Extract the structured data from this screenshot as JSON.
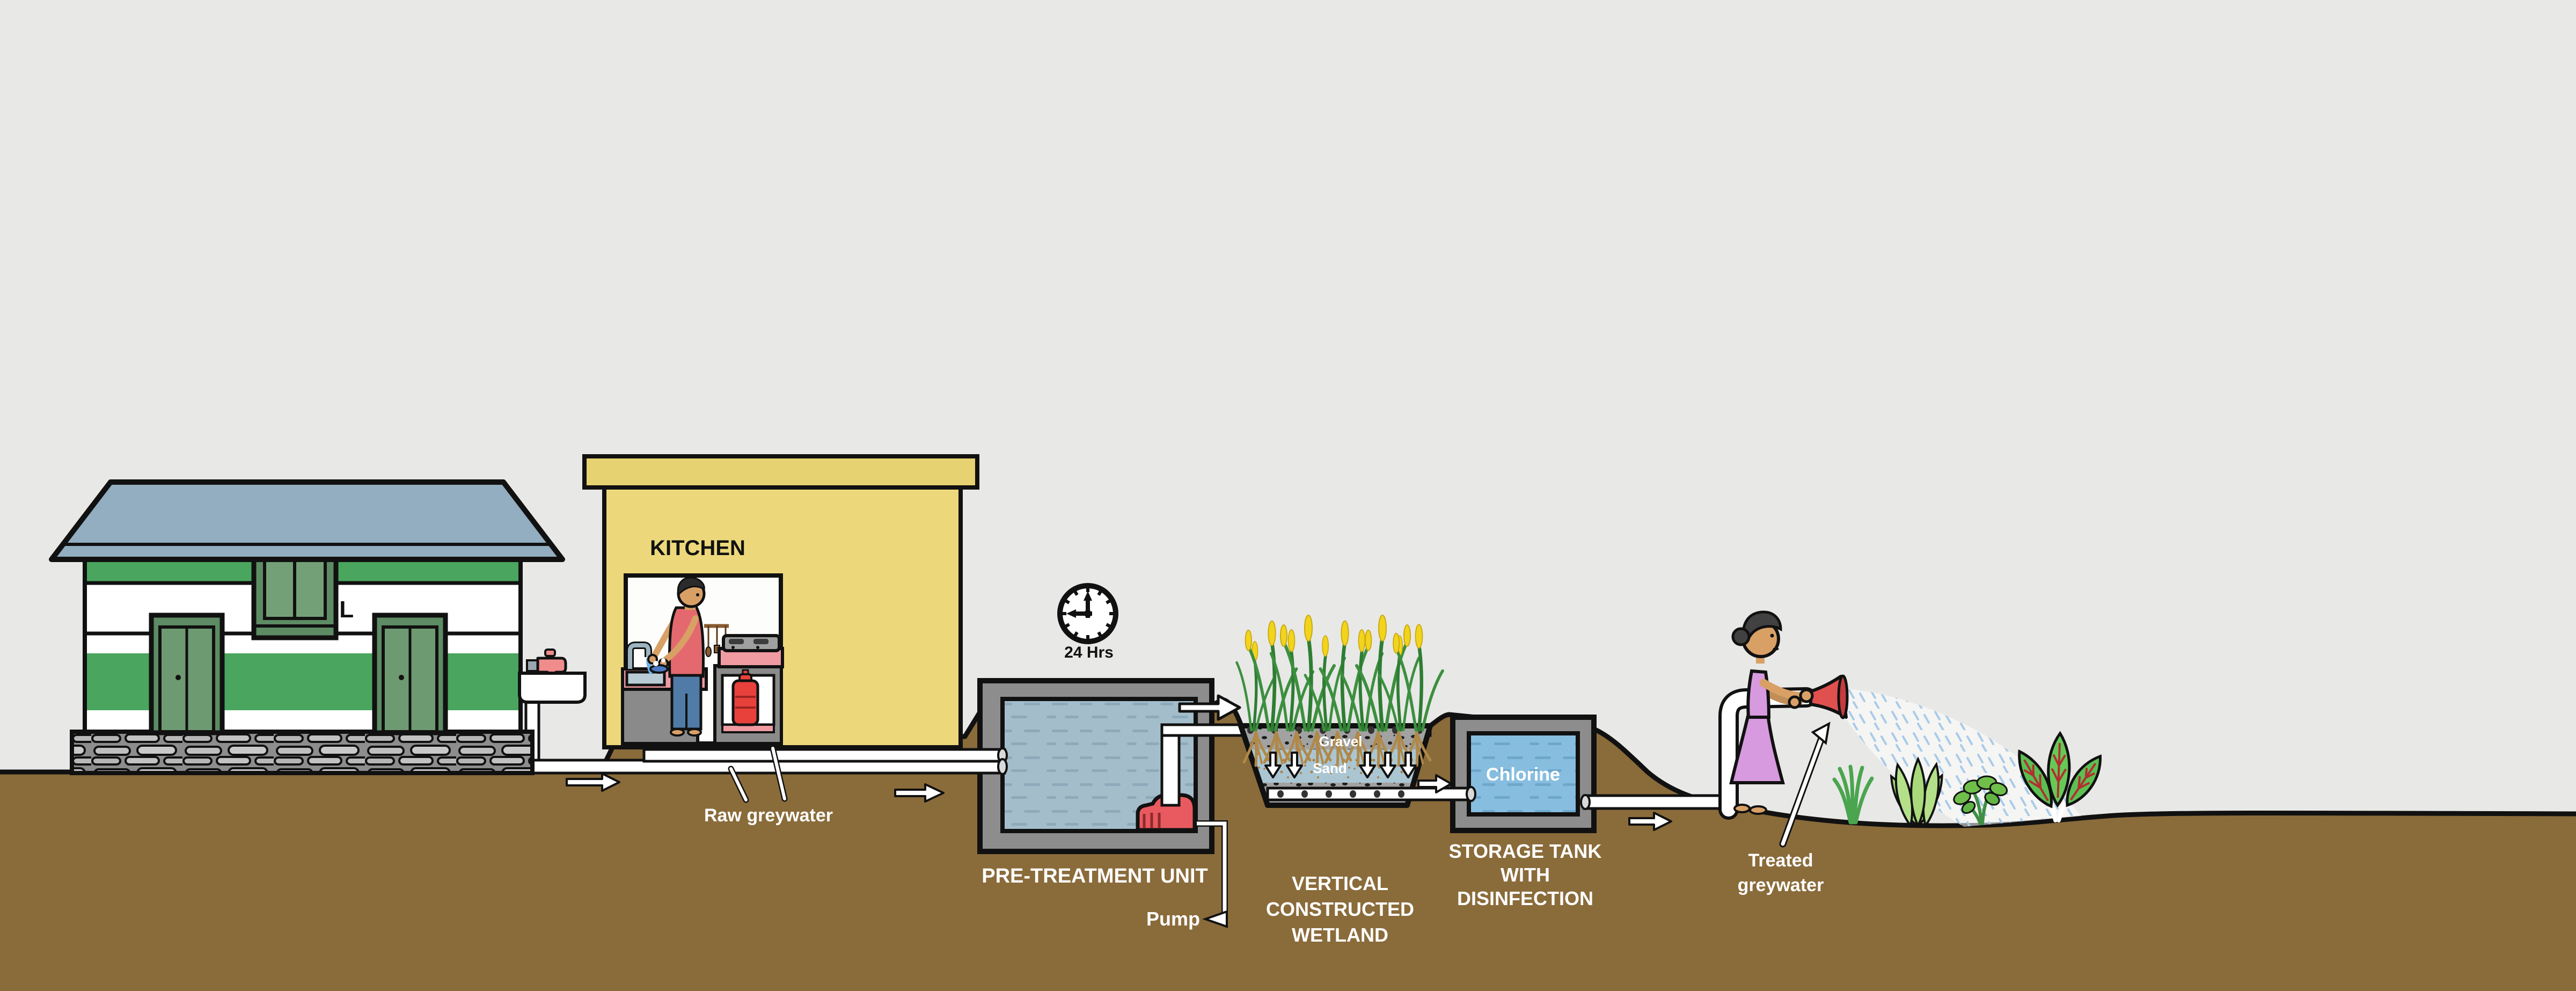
{
  "scene": {
    "sky_color": "#e8e8e7",
    "ground_color": "#8a6b3a",
    "pipe_color": "#ffffff",
    "accent_green": "#4aa55e",
    "water_color": "#a4bdcb",
    "chlorine_water_color": "#87bedf"
  },
  "school": {
    "label": "SCHOOL"
  },
  "kitchen": {
    "label": "KITCHEN"
  },
  "clock": {
    "label": "24 Hrs",
    "time_shown": "9:00"
  },
  "flow": {
    "raw_greywater_label": "Raw greywater",
    "treated_line1": "Treated",
    "treated_line2": "greywater"
  },
  "pretreatment": {
    "label": "PRE-TREATMENT UNIT",
    "pump_label": "Pump"
  },
  "wetland": {
    "line1": "VERTICAL",
    "line2": "CONSTRUCTED",
    "line3": "WETLAND",
    "gravel_label": "Gravel",
    "sand_label": "Sand"
  },
  "storage": {
    "chlorine_label": "Chlorine",
    "line1": "STORAGE TANK",
    "line2": "WITH",
    "line3": "DISINFECTION"
  }
}
